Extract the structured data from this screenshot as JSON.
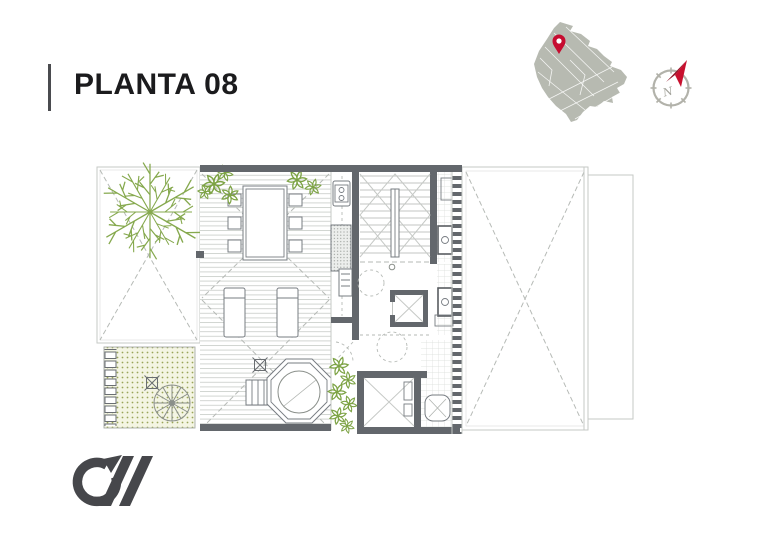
{
  "header": {
    "title": "PLANTA 08"
  },
  "compass": {
    "cardinal_label": "N"
  },
  "colors": {
    "title_text": "#1b1b1d",
    "title_bar": "#4a4b4f",
    "accent_red": "#c8102e",
    "pin_red": "#c60c30",
    "needle_dark": "#8f1326",
    "map_fill": "#b7bab1",
    "map_street": "#ffffff",
    "compass_ring": "#b2b2aa",
    "compass_letter": "#a3a39b",
    "vegetation": "#7da345",
    "tree_green": "#86a94e",
    "garden_bg": "#f4f5e3",
    "garden_dot": "#9aa55a",
    "wall_dark": "#63676c",
    "line_mid": "#8a8f8a",
    "line_light": "#c6c9c6",
    "dash_line": "#b6bab6",
    "deck_line": "#cdd0cd",
    "fixture_line": "#777c82",
    "logo_gray": "#46474b"
  }
}
